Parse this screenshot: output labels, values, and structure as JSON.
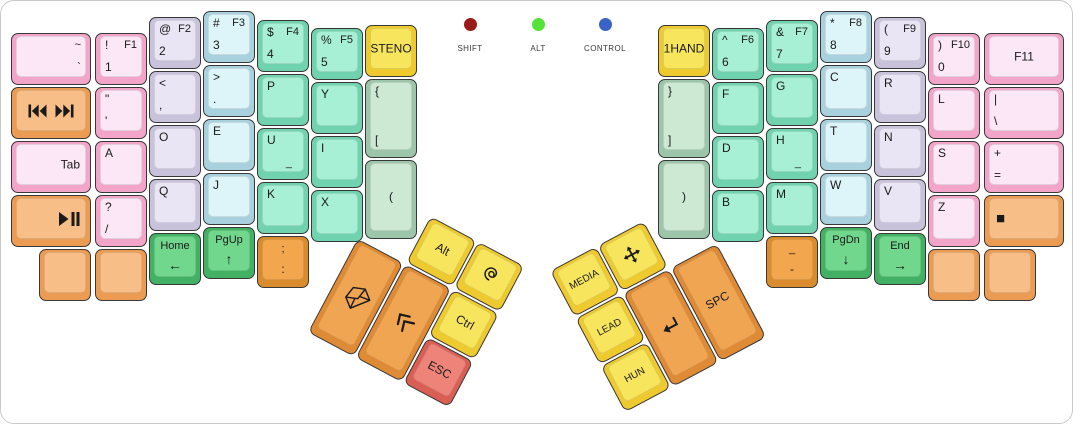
{
  "title": "Ergodox Dvorak keyboard layout",
  "palette": {
    "pink": {
      "side": "#F2A5C8",
      "top": "#FBE7F5"
    },
    "lavender": {
      "side": "#C8C3DA",
      "top": "#E9E5F4"
    },
    "cyan": {
      "side": "#A8D1DD",
      "top": "#DDF4F9"
    },
    "mint": {
      "side": "#70D2AF",
      "top": "#A8F0D5"
    },
    "sage": {
      "side": "#9CC5A9",
      "top": "#CDE9D4"
    },
    "yellow": {
      "side": "#EFCA2F",
      "top": "#F8E55E"
    },
    "navgreen": {
      "side": "#43B163",
      "top": "#71D78D"
    },
    "lorange": {
      "side": "#EC9B52",
      "top": "#F7BE87"
    },
    "dorange": {
      "side": "#D98C2E",
      "top": "#F2A74E"
    },
    "torange": {
      "side": "#DF8A35",
      "top": "#F0A553"
    },
    "red": {
      "side": "#D95F55",
      "top": "#EE837A"
    }
  },
  "indicators": [
    {
      "label": "SHIFT",
      "color": "#9B1B1B",
      "x": 469
    },
    {
      "label": "ALT",
      "color": "#55E23A",
      "x": 537
    },
    {
      "label": "CONTROL",
      "color": "#3A63C8",
      "x": 604
    }
  ],
  "left_half": {
    "keys": [
      {
        "id": "grave",
        "x": 10,
        "y": 32,
        "w": 80,
        "color": "pink",
        "legends": [
          {
            "p": "tr",
            "t": "~"
          },
          {
            "p": "br",
            "t": "`"
          }
        ]
      },
      {
        "id": "media-prev-next",
        "x": 10,
        "y": 86,
        "w": 80,
        "color": "lorange",
        "legends": [
          {
            "p": "c",
            "row": [
              "prev-track",
              "next-track"
            ]
          }
        ]
      },
      {
        "id": "tab",
        "x": 10,
        "y": 140,
        "w": 80,
        "color": "pink",
        "legends": [
          {
            "p": "cr",
            "t": "Tab"
          }
        ]
      },
      {
        "id": "play-pause",
        "x": 10,
        "y": 194,
        "w": 80,
        "color": "lorange",
        "legends": [
          {
            "p": "cr",
            "i": "play-pause"
          }
        ]
      },
      {
        "id": "1",
        "x": 94,
        "y": 32,
        "color": "pink",
        "legends": [
          {
            "p": "tl",
            "t": "!"
          },
          {
            "p": "tr",
            "t": "F1"
          },
          {
            "p": "bl",
            "t": "1"
          }
        ]
      },
      {
        "id": "apostrophe",
        "x": 94,
        "y": 86,
        "color": "pink",
        "legends": [
          {
            "p": "tl",
            "t": "\""
          },
          {
            "p": "bl",
            "t": "'"
          }
        ]
      },
      {
        "id": "a",
        "x": 94,
        "y": 140,
        "color": "pink",
        "legends": [
          {
            "p": "tl",
            "t": "A"
          }
        ]
      },
      {
        "id": "slash",
        "x": 94,
        "y": 194,
        "color": "pink",
        "legends": [
          {
            "p": "tl",
            "t": "?"
          },
          {
            "p": "bl",
            "t": "/"
          }
        ]
      },
      {
        "id": "2",
        "x": 148,
        "y": 16,
        "color": "lavender",
        "legends": [
          {
            "p": "tl",
            "t": "@"
          },
          {
            "p": "tr",
            "t": "F2"
          },
          {
            "p": "bl",
            "t": "2"
          }
        ]
      },
      {
        "id": "comma",
        "x": 148,
        "y": 70,
        "color": "lavender",
        "legends": [
          {
            "p": "tl",
            "t": "<"
          },
          {
            "p": "bl",
            "t": ","
          }
        ]
      },
      {
        "id": "o",
        "x": 148,
        "y": 124,
        "color": "lavender",
        "legends": [
          {
            "p": "tl",
            "t": "O"
          }
        ]
      },
      {
        "id": "q",
        "x": 148,
        "y": 178,
        "color": "lavender",
        "legends": [
          {
            "p": "tl",
            "t": "Q"
          }
        ]
      },
      {
        "id": "3",
        "x": 202,
        "y": 10,
        "color": "cyan",
        "legends": [
          {
            "p": "tl",
            "t": "#"
          },
          {
            "p": "tr",
            "t": "F3"
          },
          {
            "p": "bl",
            "t": "3"
          }
        ]
      },
      {
        "id": "period",
        "x": 202,
        "y": 64,
        "color": "cyan",
        "legends": [
          {
            "p": "tl",
            "t": ">"
          },
          {
            "p": "bl",
            "t": "."
          }
        ]
      },
      {
        "id": "e",
        "x": 202,
        "y": 118,
        "color": "cyan",
        "legends": [
          {
            "p": "tl",
            "t": "E"
          }
        ]
      },
      {
        "id": "j",
        "x": 202,
        "y": 172,
        "color": "cyan",
        "legends": [
          {
            "p": "tl",
            "t": "J"
          }
        ]
      },
      {
        "id": "4",
        "x": 256,
        "y": 19,
        "color": "mint",
        "legends": [
          {
            "p": "tl",
            "t": "$"
          },
          {
            "p": "tr",
            "t": "F4"
          },
          {
            "p": "bl",
            "t": "4"
          }
        ]
      },
      {
        "id": "p",
        "x": 256,
        "y": 73,
        "color": "mint",
        "legends": [
          {
            "p": "tl",
            "t": "P"
          }
        ]
      },
      {
        "id": "u",
        "x": 256,
        "y": 127,
        "color": "mint",
        "legends": [
          {
            "p": "tl",
            "t": "U"
          },
          {
            "p": "br2",
            "t": "_"
          }
        ]
      },
      {
        "id": "k",
        "x": 256,
        "y": 181,
        "color": "mint",
        "legends": [
          {
            "p": "tl",
            "t": "K"
          }
        ]
      },
      {
        "id": "5",
        "x": 310,
        "y": 27,
        "color": "mint",
        "legends": [
          {
            "p": "tl",
            "t": "%"
          },
          {
            "p": "tr",
            "t": "F5"
          },
          {
            "p": "bl",
            "t": "5"
          }
        ]
      },
      {
        "id": "y",
        "x": 310,
        "y": 81,
        "color": "mint",
        "legends": [
          {
            "p": "tl",
            "t": "Y"
          }
        ]
      },
      {
        "id": "i",
        "x": 310,
        "y": 135,
        "color": "mint",
        "legends": [
          {
            "p": "tl",
            "t": "I"
          }
        ]
      },
      {
        "id": "x",
        "x": 310,
        "y": 189,
        "color": "mint",
        "legends": [
          {
            "p": "tl",
            "t": "X"
          }
        ]
      },
      {
        "id": "steno",
        "x": 364,
        "y": 24,
        "color": "yellow",
        "legends": [
          {
            "p": "c",
            "t": "STENO"
          }
        ]
      },
      {
        "id": "lbrace",
        "x": 364,
        "y": 78,
        "h": 79,
        "color": "sage",
        "legends": [
          {
            "p": "tl",
            "t": "{"
          },
          {
            "p": "bl",
            "t": "["
          }
        ]
      },
      {
        "id": "lparen",
        "x": 364,
        "y": 159,
        "h": 79,
        "color": "sage",
        "legends": [
          {
            "p": "c",
            "t": "("
          }
        ]
      },
      {
        "id": "blank-l1",
        "x": 38,
        "y": 248,
        "color": "lorange",
        "legends": []
      },
      {
        "id": "blank-l2",
        "x": 94,
        "y": 248,
        "color": "lorange",
        "legends": []
      },
      {
        "id": "home",
        "x": 148,
        "y": 232,
        "color": "navgreen",
        "legends": [
          {
            "p": "tc",
            "t": "Home"
          },
          {
            "p": "bc",
            "t": "←",
            "cls": "arrow"
          }
        ]
      },
      {
        "id": "pgup",
        "x": 202,
        "y": 226,
        "color": "navgreen",
        "legends": [
          {
            "p": "tc",
            "t": "PgUp"
          },
          {
            "p": "bc",
            "t": "↑",
            "cls": "arrow"
          }
        ]
      },
      {
        "id": "semicolon",
        "x": 256,
        "y": 235,
        "color": "dorange",
        "legends": [
          {
            "p": "tc",
            "t": ";"
          },
          {
            "p": "bc",
            "t": ":"
          }
        ]
      }
    ]
  },
  "right_half": {
    "keys": [
      {
        "id": "1hand",
        "x": 657,
        "y": 24,
        "color": "yellow",
        "legends": [
          {
            "p": "c",
            "t": "1HAND"
          }
        ]
      },
      {
        "id": "rbrace",
        "x": 657,
        "y": 78,
        "h": 79,
        "color": "sage",
        "legends": [
          {
            "p": "tl",
            "t": "}"
          },
          {
            "p": "bl",
            "t": "]"
          }
        ]
      },
      {
        "id": "rparen",
        "x": 657,
        "y": 159,
        "h": 79,
        "color": "sage",
        "legends": [
          {
            "p": "c",
            "t": ")"
          }
        ]
      },
      {
        "id": "6",
        "x": 711,
        "y": 27,
        "color": "mint",
        "legends": [
          {
            "p": "tl",
            "t": "^"
          },
          {
            "p": "tr",
            "t": "F6"
          },
          {
            "p": "bl",
            "t": "6"
          }
        ]
      },
      {
        "id": "f",
        "x": 711,
        "y": 81,
        "color": "mint",
        "legends": [
          {
            "p": "tl",
            "t": "F"
          }
        ]
      },
      {
        "id": "d",
        "x": 711,
        "y": 135,
        "color": "mint",
        "legends": [
          {
            "p": "tl",
            "t": "D"
          }
        ]
      },
      {
        "id": "b",
        "x": 711,
        "y": 189,
        "color": "mint",
        "legends": [
          {
            "p": "tl",
            "t": "B"
          }
        ]
      },
      {
        "id": "7",
        "x": 765,
        "y": 19,
        "color": "mint",
        "legends": [
          {
            "p": "tl",
            "t": "&"
          },
          {
            "p": "tr",
            "t": "F7"
          },
          {
            "p": "bl",
            "t": "7"
          }
        ]
      },
      {
        "id": "g",
        "x": 765,
        "y": 73,
        "color": "mint",
        "legends": [
          {
            "p": "tl",
            "t": "G"
          }
        ]
      },
      {
        "id": "h",
        "x": 765,
        "y": 127,
        "color": "mint",
        "legends": [
          {
            "p": "tl",
            "t": "H"
          },
          {
            "p": "br2",
            "t": "_"
          }
        ]
      },
      {
        "id": "m",
        "x": 765,
        "y": 181,
        "color": "mint",
        "legends": [
          {
            "p": "tl",
            "t": "M"
          }
        ]
      },
      {
        "id": "underscore",
        "x": 765,
        "y": 235,
        "color": "dorange",
        "legends": [
          {
            "p": "tc",
            "t": "_"
          },
          {
            "p": "bc",
            "t": "-"
          }
        ]
      },
      {
        "id": "8",
        "x": 819,
        "y": 10,
        "color": "cyan",
        "legends": [
          {
            "p": "tl",
            "t": "*"
          },
          {
            "p": "tr",
            "t": "F8"
          },
          {
            "p": "bl",
            "t": "8"
          }
        ]
      },
      {
        "id": "c",
        "x": 819,
        "y": 64,
        "color": "cyan",
        "legends": [
          {
            "p": "tl",
            "t": "C"
          }
        ]
      },
      {
        "id": "t",
        "x": 819,
        "y": 118,
        "color": "cyan",
        "legends": [
          {
            "p": "tl",
            "t": "T"
          }
        ]
      },
      {
        "id": "w",
        "x": 819,
        "y": 172,
        "color": "cyan",
        "legends": [
          {
            "p": "tl",
            "t": "W"
          }
        ]
      },
      {
        "id": "pgdn",
        "x": 819,
        "y": 226,
        "color": "navgreen",
        "legends": [
          {
            "p": "tc",
            "t": "PgDn"
          },
          {
            "p": "bc",
            "t": "↓",
            "cls": "arrow"
          }
        ]
      },
      {
        "id": "9",
        "x": 873,
        "y": 16,
        "color": "lavender",
        "legends": [
          {
            "p": "tl",
            "t": "("
          },
          {
            "p": "tr",
            "t": "F9"
          },
          {
            "p": "bl",
            "t": "9"
          }
        ]
      },
      {
        "id": "r",
        "x": 873,
        "y": 70,
        "color": "lavender",
        "legends": [
          {
            "p": "tl",
            "t": "R"
          }
        ]
      },
      {
        "id": "n",
        "x": 873,
        "y": 124,
        "color": "lavender",
        "legends": [
          {
            "p": "tl",
            "t": "N"
          }
        ]
      },
      {
        "id": "v",
        "x": 873,
        "y": 178,
        "color": "lavender",
        "legends": [
          {
            "p": "tl",
            "t": "V"
          }
        ]
      },
      {
        "id": "end",
        "x": 873,
        "y": 232,
        "color": "navgreen",
        "legends": [
          {
            "p": "tc",
            "t": "End"
          },
          {
            "p": "bc",
            "t": "→",
            "cls": "arrow"
          }
        ]
      },
      {
        "id": "0",
        "x": 927,
        "y": 32,
        "color": "pink",
        "legends": [
          {
            "p": "tl",
            "t": ")"
          },
          {
            "p": "tr",
            "t": "F10"
          },
          {
            "p": "bl",
            "t": "0"
          }
        ]
      },
      {
        "id": "l",
        "x": 927,
        "y": 86,
        "color": "pink",
        "legends": [
          {
            "p": "tl",
            "t": "L"
          }
        ]
      },
      {
        "id": "s",
        "x": 927,
        "y": 140,
        "color": "pink",
        "legends": [
          {
            "p": "tl",
            "t": "S"
          }
        ]
      },
      {
        "id": "z",
        "x": 927,
        "y": 194,
        "color": "pink",
        "legends": [
          {
            "p": "tl",
            "t": "Z"
          }
        ]
      },
      {
        "id": "blank-r1",
        "x": 927,
        "y": 248,
        "color": "lorange",
        "legends": []
      },
      {
        "id": "f11",
        "x": 983,
        "y": 32,
        "w": 80,
        "color": "pink",
        "legends": [
          {
            "p": "c",
            "t": "F11"
          }
        ]
      },
      {
        "id": "backslash",
        "x": 983,
        "y": 86,
        "w": 80,
        "color": "pink",
        "legends": [
          {
            "p": "tl",
            "t": "|"
          },
          {
            "p": "bl",
            "t": "\\"
          }
        ]
      },
      {
        "id": "equals",
        "x": 983,
        "y": 140,
        "w": 80,
        "color": "pink",
        "legends": [
          {
            "p": "tl",
            "t": "+"
          },
          {
            "p": "bl",
            "t": "="
          }
        ]
      },
      {
        "id": "stop",
        "x": 983,
        "y": 194,
        "w": 80,
        "color": "lorange",
        "legends": [
          {
            "p": "cl",
            "t": "■",
            "cls": "stopglyph"
          }
        ]
      },
      {
        "id": "blank-r2",
        "x": 983,
        "y": 248,
        "color": "lorange",
        "legends": []
      }
    ]
  },
  "thumb_left": {
    "origin_x": 382,
    "origin_y": 190,
    "rotation_deg": 28,
    "keys": [
      {
        "id": "alt",
        "x": 54,
        "y": 0,
        "color": "yellow",
        "legends": [
          {
            "p": "c",
            "t": "Alt"
          }
        ]
      },
      {
        "id": "super",
        "x": 108,
        "y": 0,
        "color": "yellow",
        "legends": [
          {
            "p": "c",
            "i": "debian-swirl"
          }
        ]
      },
      {
        "id": "mail",
        "x": 0,
        "y": 54,
        "h": 106,
        "color": "torange",
        "legends": [
          {
            "p": "c",
            "i": "envelope",
            "r": -50
          }
        ]
      },
      {
        "id": "chevrons",
        "x": 54,
        "y": 54,
        "h": 106,
        "color": "torange",
        "legends": [
          {
            "p": "c",
            "i": "double-chevron",
            "r": -60
          }
        ]
      },
      {
        "id": "ctrl",
        "x": 108,
        "y": 54,
        "color": "yellow",
        "legends": [
          {
            "p": "c",
            "t": "Ctrl"
          }
        ]
      },
      {
        "id": "esc",
        "x": 108,
        "y": 108,
        "color": "red",
        "legends": [
          {
            "p": "c",
            "t": "ESC"
          }
        ]
      }
    ]
  },
  "thumb_right": {
    "origin_x": 549,
    "origin_y": 270,
    "rotation_deg": -28,
    "keys": [
      {
        "id": "media",
        "x": 0,
        "y": 0,
        "color": "yellow",
        "legends": [
          {
            "p": "c",
            "t": "MEDIA",
            "cls": "fs10"
          }
        ]
      },
      {
        "id": "move",
        "x": 54,
        "y": 0,
        "color": "yellow",
        "legends": [
          {
            "p": "c",
            "i": "move"
          }
        ]
      },
      {
        "id": "lead",
        "x": 0,
        "y": 54,
        "color": "yellow",
        "legends": [
          {
            "p": "c",
            "t": "LEAD",
            "cls": "fs10"
          }
        ]
      },
      {
        "id": "hun",
        "x": 0,
        "y": 108,
        "color": "yellow",
        "legends": [
          {
            "p": "c",
            "t": "HUN",
            "cls": "fs10"
          }
        ]
      },
      {
        "id": "enter",
        "x": 54,
        "y": 54,
        "h": 106,
        "color": "torange",
        "legends": [
          {
            "p": "c",
            "i": "enter-return"
          }
        ]
      },
      {
        "id": "spc",
        "x": 108,
        "y": 54,
        "h": 106,
        "color": "torange",
        "legends": [
          {
            "p": "c",
            "t": "SPC"
          }
        ]
      }
    ]
  }
}
